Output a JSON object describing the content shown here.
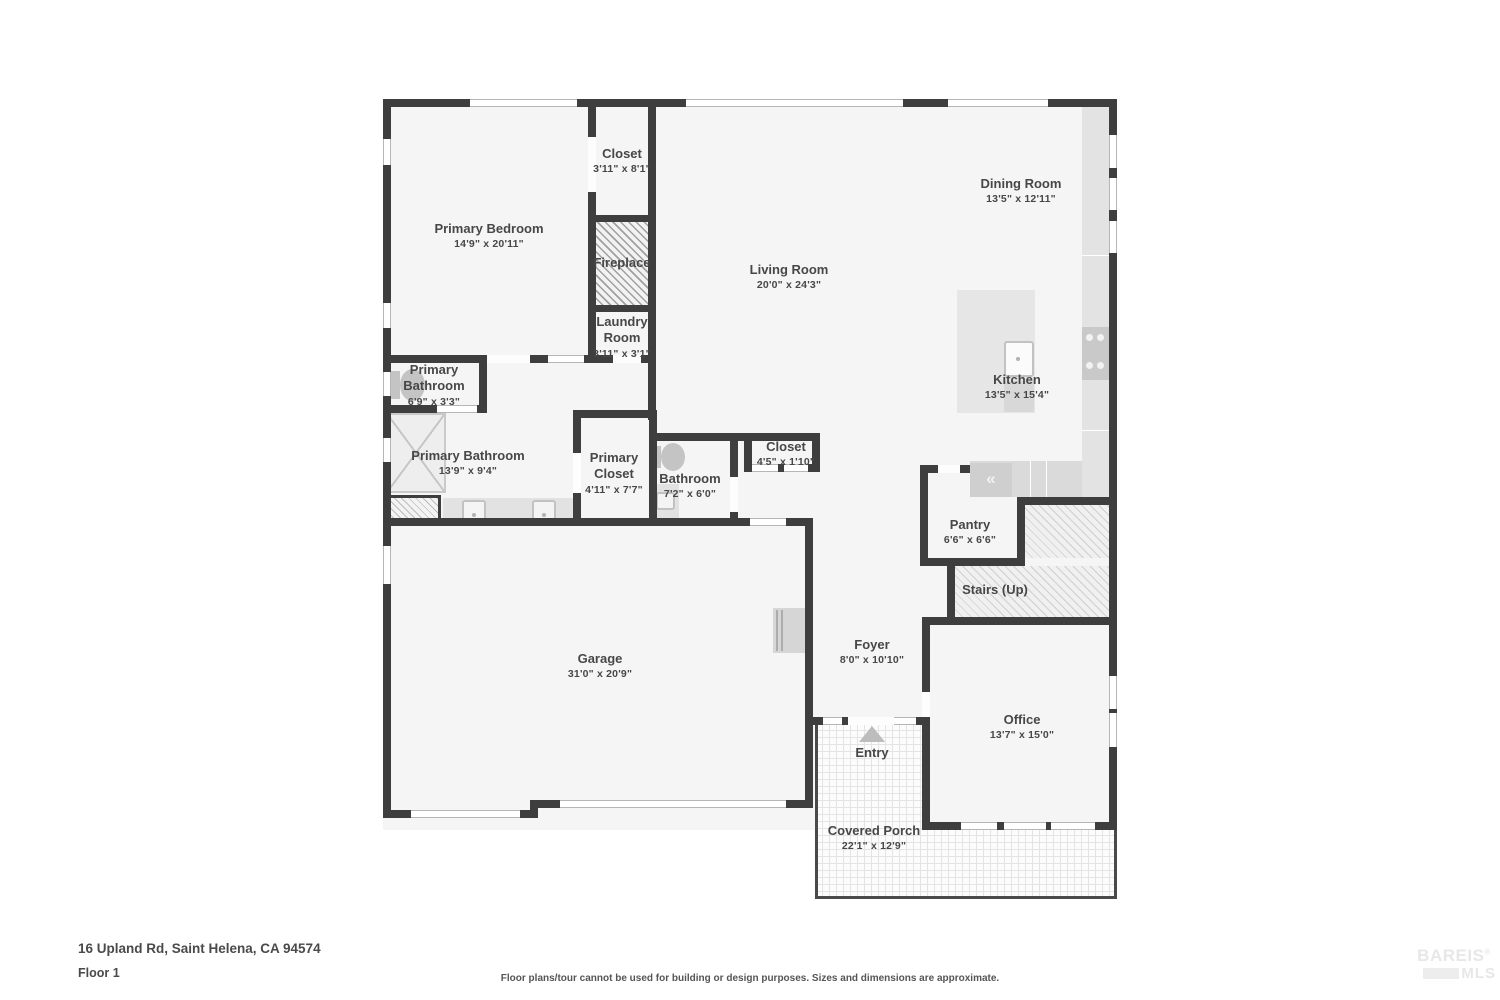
{
  "page": {
    "address": "16 Upland Rd, Saint Helena, CA 94574",
    "floor_label": "Floor 1",
    "disclaimer": "Floor plans/tour cannot be used for building or design purposes. Sizes and dimensions are approximate.",
    "logo": {
      "brand": "BAREIS",
      "reg": "®",
      "sub": "MLS"
    }
  },
  "colors": {
    "wall": "#3e3e3e",
    "floor": "#f5f5f5",
    "label_text": "#474747"
  },
  "fixtures": {
    "fridge_glyph": "«"
  },
  "rooms": [
    {
      "name": "Closet",
      "dims": "3'11\" x 8'1\""
    },
    {
      "name": "Primary Bedroom",
      "dims": "14'9\" x 20'11\""
    },
    {
      "name": "Fireplace",
      "dims": ""
    },
    {
      "name": "Laundry Room",
      "dims": "3'11\" x 3'1\""
    },
    {
      "name": "Dining Room",
      "dims": "13'5\" x 12'11\""
    },
    {
      "name": "Living Room",
      "dims": "20'0\" x 24'3\""
    },
    {
      "name": "Kitchen",
      "dims": "13'5\" x 15'4\""
    },
    {
      "name": "Primary Bathroom",
      "dims": "6'9\" x 3'3\""
    },
    {
      "name": "Primary Bathroom",
      "dims": "13'9\" x 9'4\""
    },
    {
      "name": "Primary Closet",
      "dims": "4'11\" x 7'7\""
    },
    {
      "name": "Bathroom",
      "dims": "7'2\" x 6'0\""
    },
    {
      "name": "Closet",
      "dims": "4'5\" x 1'10\""
    },
    {
      "name": "Pantry",
      "dims": "6'6\" x 6'6\""
    },
    {
      "name": "Stairs (Up)",
      "dims": ""
    },
    {
      "name": "Garage",
      "dims": "31'0\" x 20'9\""
    },
    {
      "name": "Foyer",
      "dims": "8'0\" x 10'10\""
    },
    {
      "name": "Entry",
      "dims": ""
    },
    {
      "name": "Office",
      "dims": "13'7\" x 15'0\""
    },
    {
      "name": "Covered Porch",
      "dims": "22'1\" x 12'9\""
    }
  ]
}
